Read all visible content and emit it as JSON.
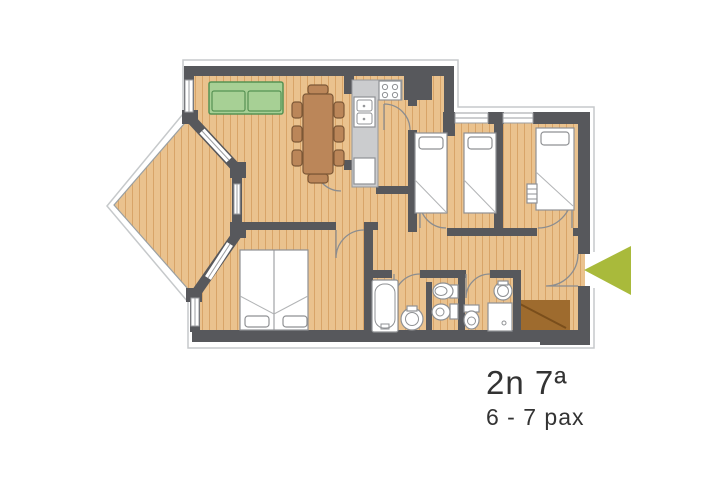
{
  "labels": {
    "unit": "2n 7ª",
    "capacity": "6 - 7 pax"
  },
  "icons": {
    "entrance_arrow": "left-pointing-triangle"
  },
  "colors": {
    "floor": "#eac28e",
    "plank": "#d8a468",
    "wall": "#57585c",
    "window": "#ffffff",
    "window_frame": "#9b9da0",
    "outline": "#c6c9cb",
    "terrace_edge": "#9aa0a3",
    "door_arc": "#8b8d90",
    "sofa": "#a7d095",
    "sofa_border": "#569253",
    "wood_furniture": "#bb8659",
    "wood_furniture_border": "#7d5837",
    "counter": "#cbccce",
    "counter_border": "#97999c",
    "fixture": "#ffffff",
    "fixture_border": "#8f9194",
    "fold": "#b2b4b6",
    "entry_mat": "#9e6b2e",
    "entry_mat_line": "#7a4e1b",
    "arrow": "#a9ba3b",
    "text": "#333333"
  }
}
